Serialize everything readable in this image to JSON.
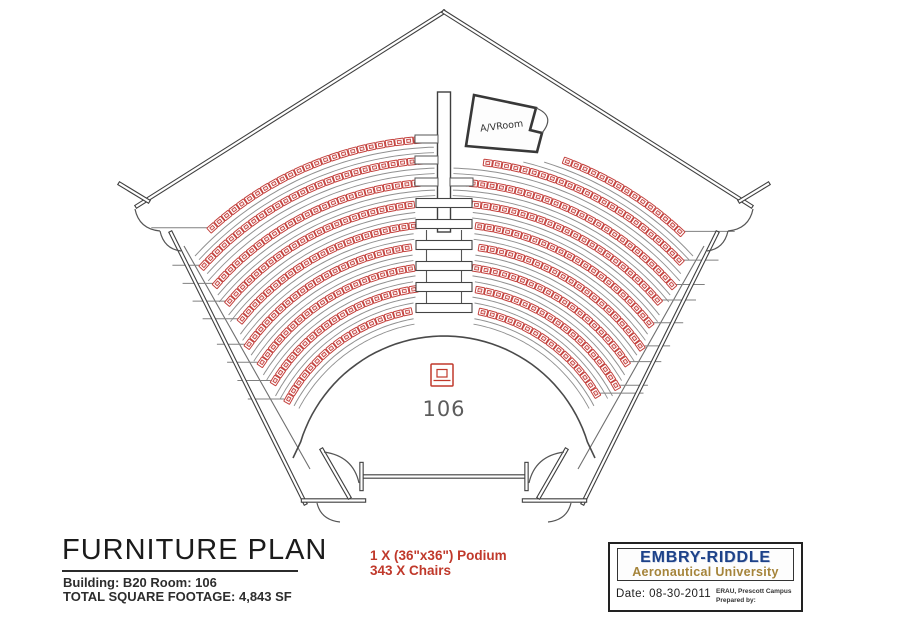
{
  "title_block": {
    "title": "FURNITURE PLAN",
    "building_line": "Building: B20 Room: 106",
    "footage_line": "TOTAL SQUARE FOOTAGE: 4,843 SF"
  },
  "legend": {
    "podium_line": "1 X (36\"x36\") Podium",
    "chairs_line": "343 X Chairs"
  },
  "logo_block": {
    "name_line1": "EMBRY-RIDDLE",
    "name_line2": "Aeronautical University",
    "date_label": "Date:",
    "date_value": "08-30-2011",
    "campus_line": "ERAU, Prescott Campus",
    "prepared_line": "Prepared by:"
  },
  "room": {
    "number": "106",
    "av_room_label": "A/VRoom"
  },
  "colors": {
    "wall": "#3f3f3f",
    "thin_line": "#6f6f6f",
    "row_arc": "#909090",
    "chair_red": "#c3403c",
    "legend_red": "#c0392b",
    "podium_red": "#c0392b",
    "room_number_gray": "#5c5c5c",
    "logo_blue": "#1d4289",
    "logo_gold": "#a5843a"
  },
  "seating": {
    "center_x": 444,
    "center_y": 486,
    "row_radii": [
      178,
      199,
      220,
      241,
      262,
      283,
      304,
      326,
      347
    ],
    "chair_spacing": 9.5,
    "chair_w": 8.6,
    "chair_h": 6.6,
    "max_theta": 1.06,
    "narrow_aisle_half": 10,
    "wide_aisle_half": 30,
    "narrow_if_above_y": 195,
    "av_rect": [
      450,
      88,
      562,
      162
    ],
    "aisle_box_rows_y": [
      203,
      224,
      245,
      266,
      287,
      308
    ],
    "aisle_mini_rows_y": [
      139,
      160,
      182
    ]
  }
}
